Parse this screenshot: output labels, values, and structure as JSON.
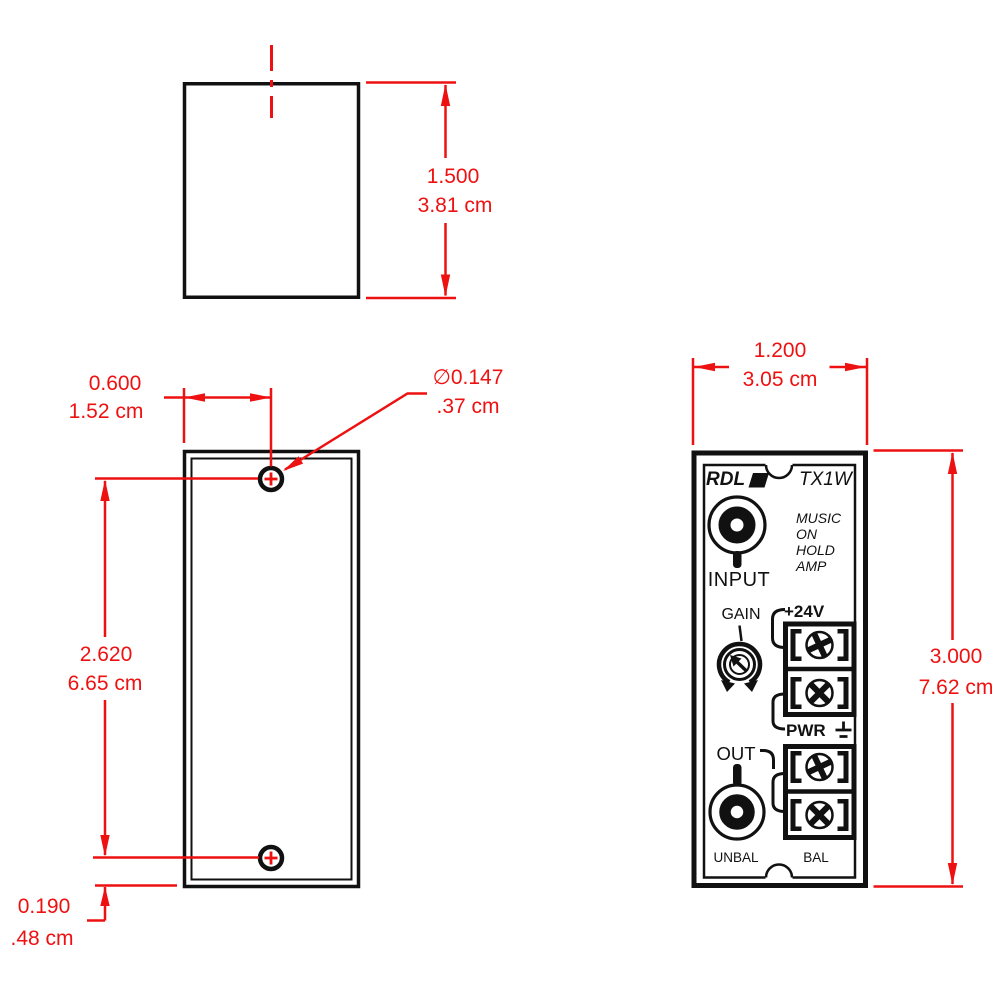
{
  "title": "RDL TX1W module mounting dimension drawing",
  "colors": {
    "dimension_red": "#ee1111",
    "drawing_black": "#111111"
  },
  "dimensions": {
    "side_height_in": "1.500",
    "side_height_cm": "3.81 cm",
    "hole_offset_in": "0.600",
    "hole_offset_cm": "1.52 cm",
    "hole_diameter_in": "∅0.147",
    "hole_diameter_cm": ".37 cm",
    "hole_spacing_in": "2.620",
    "hole_spacing_cm": "6.65 cm",
    "hole_bottom_in": "0.190",
    "hole_bottom_cm": ".48 cm",
    "panel_width_in": "1.200",
    "panel_width_cm": "3.05 cm",
    "panel_height_in": "3.000",
    "panel_height_cm": "7.62 cm"
  },
  "panel": {
    "brand": "RDL",
    "model": "TX1W",
    "description_lines": [
      "MUSIC",
      "ON",
      "HOLD",
      "AMP"
    ],
    "input_label": "INPUT",
    "gain_label": "GAIN",
    "supply_label": "+24V",
    "power_label": "PWR",
    "output_label": "OUT",
    "unbalanced_label": "UNBAL",
    "balanced_label": "BAL"
  }
}
